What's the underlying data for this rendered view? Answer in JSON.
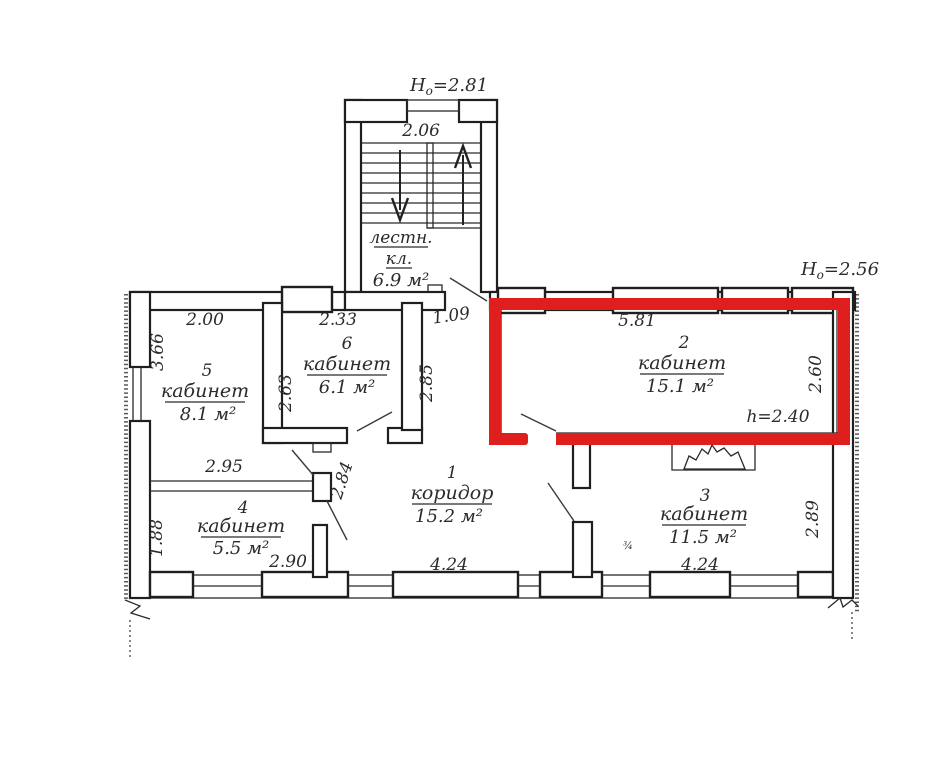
{
  "colors": {
    "highlight_red": "#df1e1e",
    "ink": "#2b2b2b"
  },
  "annotations": {
    "h0_left": {
      "base": "H",
      "sub": "o",
      "value": "=2.81"
    },
    "h0_right": {
      "base": "H",
      "sub": "o",
      "value": "=2.56"
    },
    "height_note": "h=2.40",
    "stray_mark": "¾"
  },
  "staircase": {
    "label_line1": "лестн.",
    "label_line2": "кл.",
    "area": "6.9 м²"
  },
  "rooms": {
    "r1": {
      "number": "1",
      "name": "коридор",
      "area": "15.2 м²"
    },
    "r2": {
      "number": "2",
      "name": "кабинет",
      "area": "15.1 м²",
      "highlighted": true
    },
    "r3": {
      "number": "3",
      "name": "кабинет",
      "area": "11.5 м²"
    },
    "r4": {
      "number": "4",
      "name": "кабинет",
      "area": "5.5 м²"
    },
    "r5": {
      "number": "5",
      "name": "кабинет",
      "area": "8.1 м²"
    },
    "r6": {
      "number": "6",
      "name": "кабинет",
      "area": "6.1 м²"
    }
  },
  "dimensions": {
    "stair_inner": "2.06",
    "room5_top": "2.00",
    "room5_side": "3.66",
    "room6_top": "2.33",
    "room6_left": "2.63",
    "room6_right": "2.85",
    "entry_width": "1.09",
    "room2_top": "5.81",
    "room2_side": "2.60",
    "partition_len": "2.95",
    "room4_side": "1.88",
    "room4_bottom": "2.90",
    "mid_wall": "2.84",
    "corridor_bottom": "4.24",
    "room3_bottom": "4.24",
    "room3_side": "2.89"
  }
}
